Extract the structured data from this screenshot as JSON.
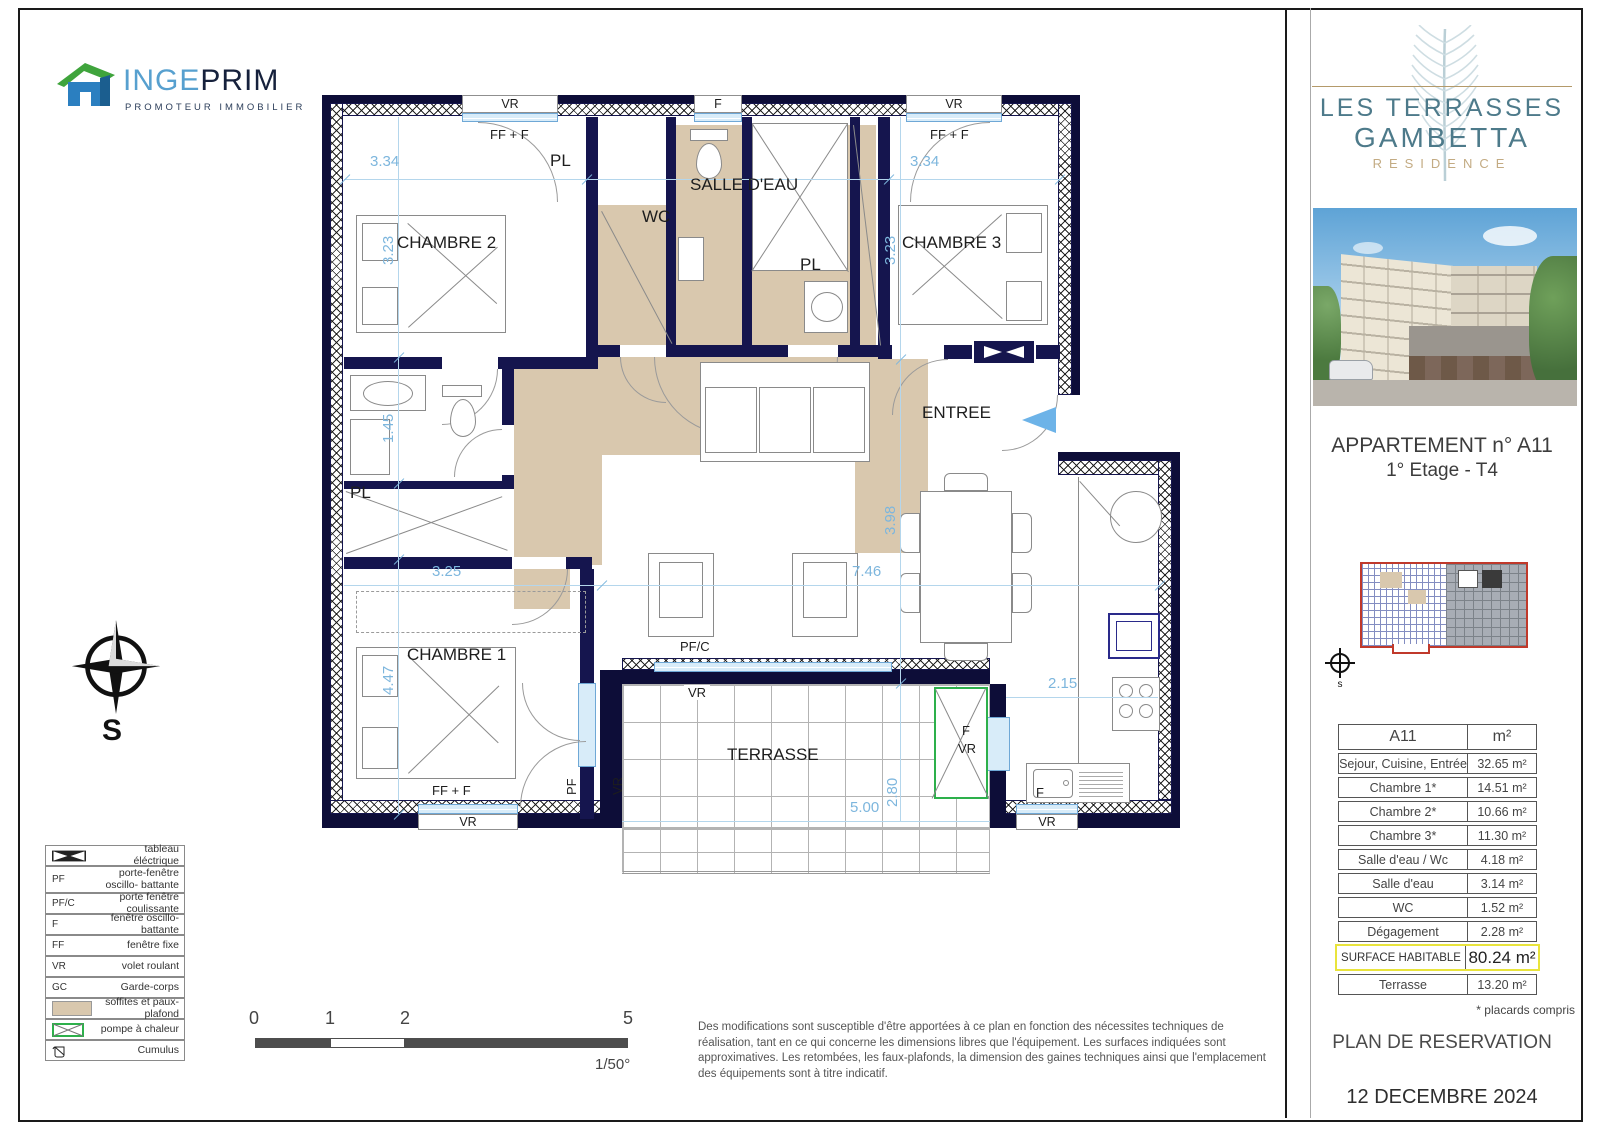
{
  "logo": {
    "name_part1": "INGE",
    "name_part2": "PRIM",
    "tagline": "PROMOTEUR IMMOBILIER"
  },
  "plan": {
    "rooms": {
      "chambre1": "CHAMBRE 1",
      "chambre2": "CHAMBRE 2",
      "chambre3": "CHAMBRE 3",
      "wc": "WC",
      "salle_deau": "SALLE D'EAU",
      "terrasse": "TERRASSE",
      "entree": "ENTREE",
      "placard": "PL"
    },
    "windows": {
      "vr": "VR",
      "ff_f": "FF + F",
      "f": "F",
      "pfc": "PF/C",
      "pf": "PF"
    },
    "dims": {
      "d1": "3.34",
      "d2": "3.34",
      "d3": "3.23",
      "d4": "3.23",
      "d5": "1.45",
      "d6": "3.25",
      "d7": "7.46",
      "d8": "3.98",
      "d9": "4.47",
      "d10": "2.15",
      "d11": "2.80",
      "d12": "5.00"
    }
  },
  "compass": {
    "label": "S",
    "small_label": "s"
  },
  "legend": {
    "rows": [
      {
        "key": "",
        "label": "tableau éléctrique"
      },
      {
        "key": "PF",
        "label": "porte-fenêtre oscillo- battante"
      },
      {
        "key": "PF/C",
        "label": "porte fenêtre coulissante"
      },
      {
        "key": "F",
        "label": "fenêtre oscillo-battante"
      },
      {
        "key": "FF",
        "label": "fenêtre fixe"
      },
      {
        "key": "VR",
        "label": "volet roulant"
      },
      {
        "key": "GC",
        "label": "Garde-corps"
      },
      {
        "key": "",
        "label": "soffites et paux-plafond"
      },
      {
        "key": "",
        "label": "pompe à chaleur"
      },
      {
        "key": "",
        "label": "Cumulus"
      }
    ]
  },
  "scalebar": {
    "t0": "0",
    "t1": "1",
    "t2": "2",
    "t5": "5",
    "ratio": "1/50°"
  },
  "disclaimer": "Des modifications sont susceptible d'être apportées à ce plan en fonction des nécessites techniques de réalisation, tant en ce qui concerne les dimensions libres que l'équipement. Les surfaces indiquées sont approximatives. Les retombées, les faux-plafonds, la dimension des gaines techniques ainsi que l'emplacement des équipements sont à titre indicatif.",
  "sidebar": {
    "residence_line1": "LES TERRASSES",
    "residence_line2": "GAMBETTA",
    "residence_sub": "RESIDENCE",
    "apartment_title": "APPARTEMENT n° A11",
    "apartment_subtitle": "1° Etage - T4",
    "table": {
      "col1": "A11",
      "col2": "m²",
      "rows": [
        {
          "label": "Sejour, Cuisine, Entrée",
          "value": "32.65 m²"
        },
        {
          "label": "Chambre 1*",
          "value": "14.51 m²"
        },
        {
          "label": "Chambre 2*",
          "value": "10.66 m²"
        },
        {
          "label": "Chambre 3*",
          "value": "11.30 m²"
        },
        {
          "label": "Salle d'eau / Wc",
          "value": "4.18 m²"
        },
        {
          "label": "Salle d'eau",
          "value": "3.14 m²"
        },
        {
          "label": "WC",
          "value": "1.52 m²"
        },
        {
          "label": "Dégagement",
          "value": "2.28 m²"
        }
      ],
      "highlight": {
        "label": "SURFACE HABITABLE",
        "value": "80.24 m²"
      },
      "terrace_row": {
        "label": "Terrasse",
        "value": "13.20 m²"
      }
    },
    "note": "* placards compris",
    "plan_type": "PLAN DE RESERVATION",
    "date": "12 DECEMBRE 2024"
  }
}
